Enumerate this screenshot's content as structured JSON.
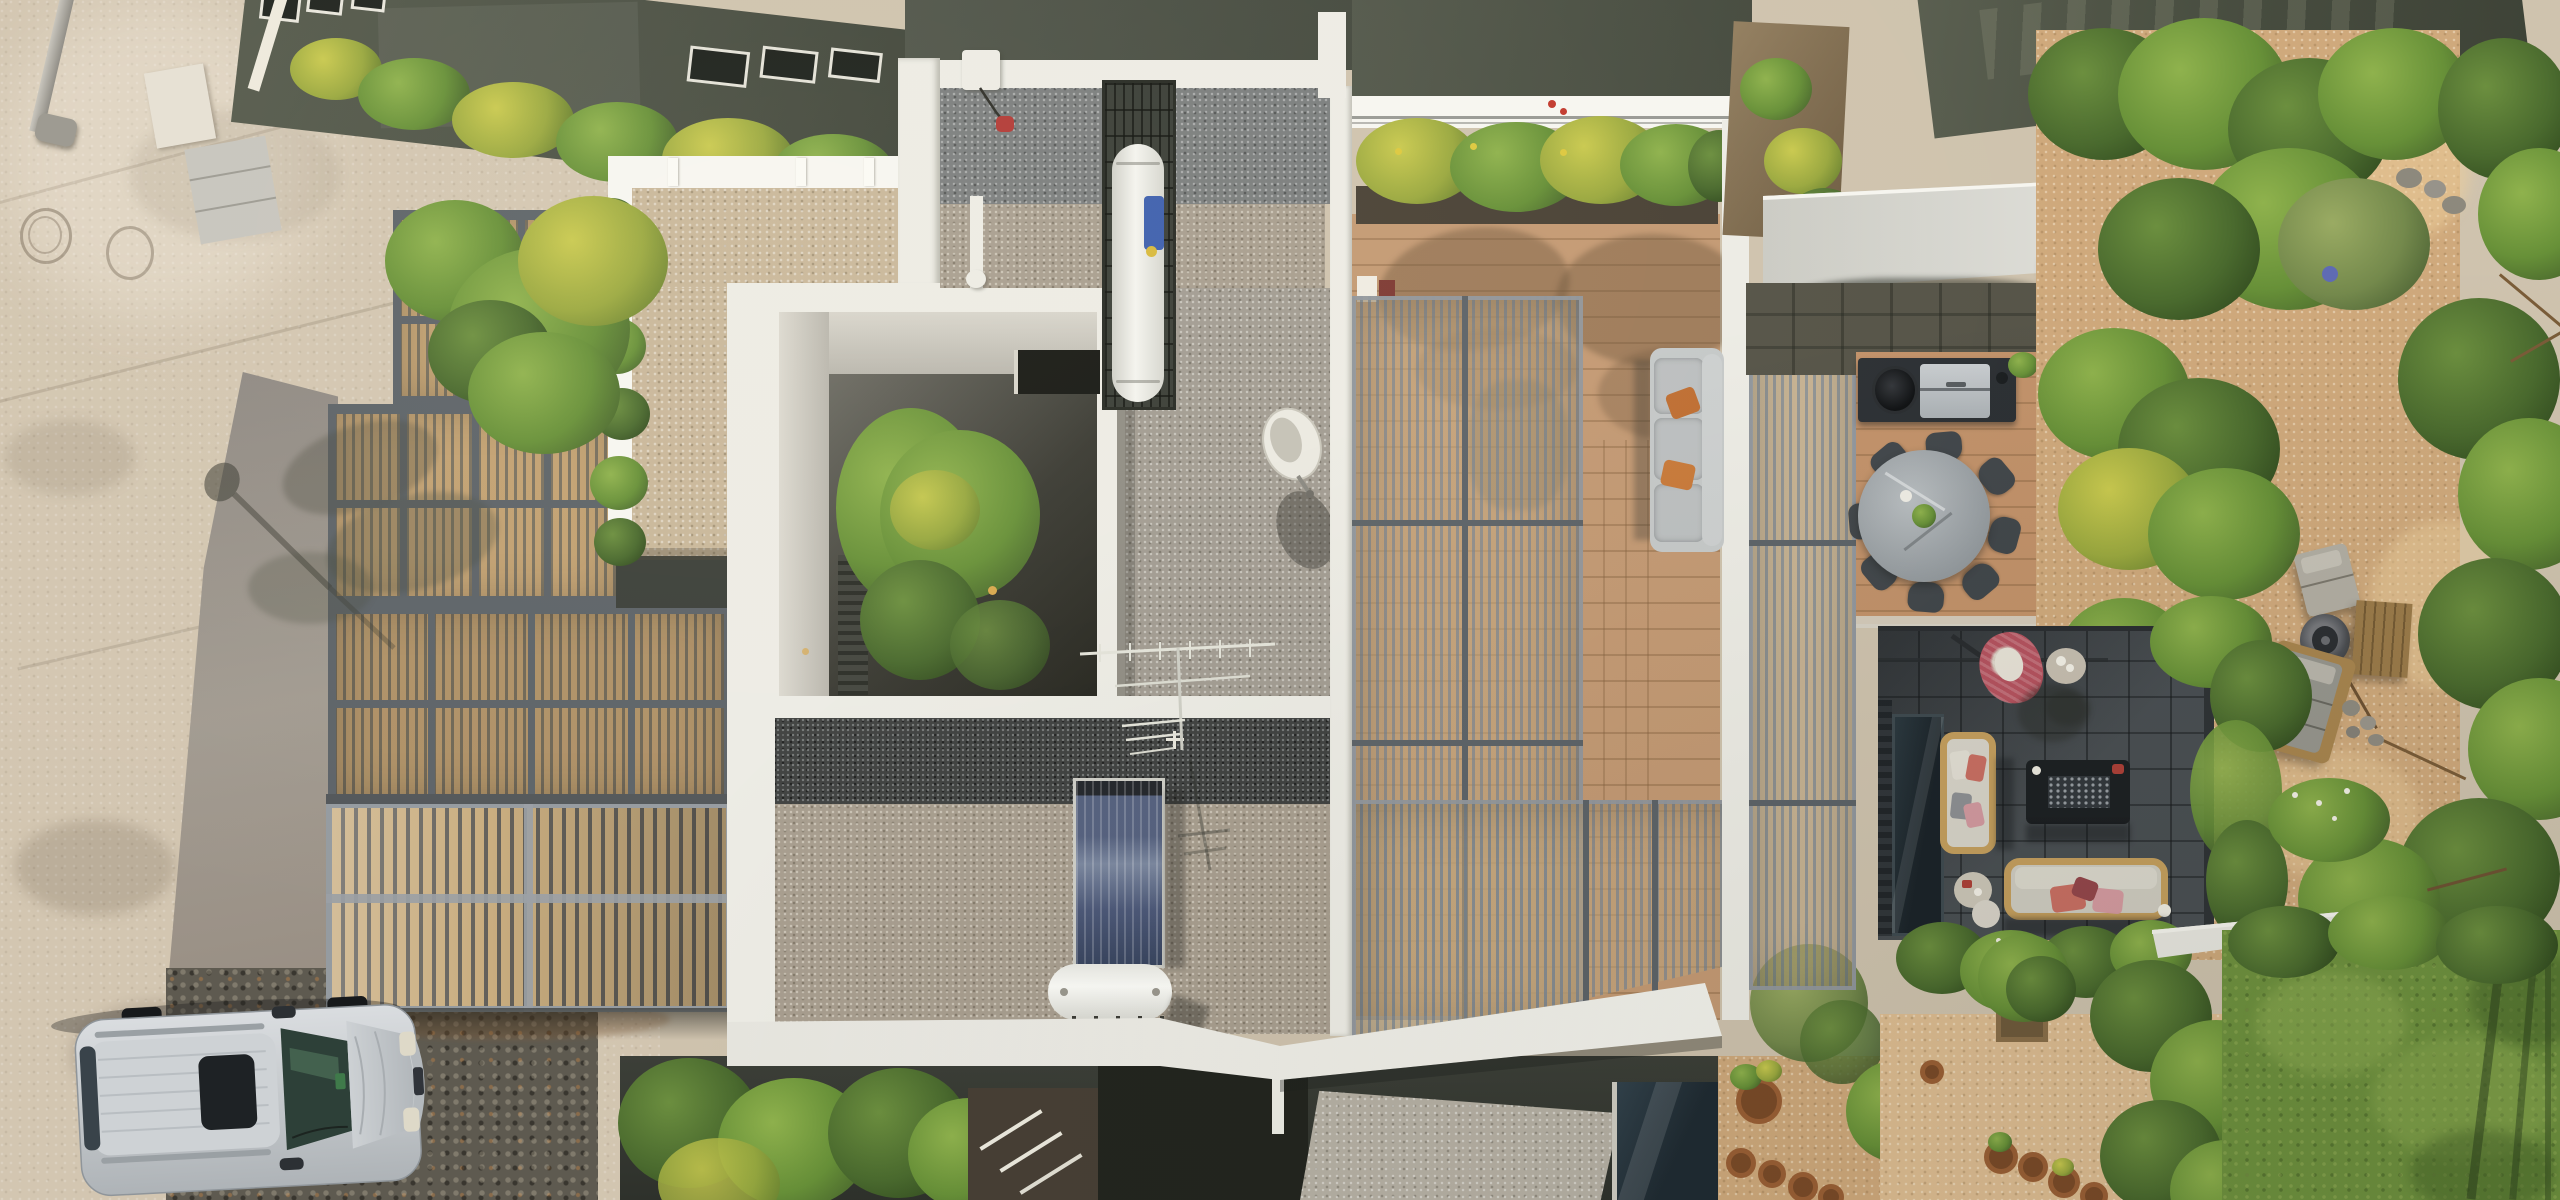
{
  "scene": {
    "description": "Overhead drone photograph of a modern flat-roofed house: beige street and silver SUV at left, slatted louver pergola roof and garage gate, white-bordered gravel roofs, open courtyard with a green tree, solar panel and water tank, east timber-deck terrace with privacy screens and gray sofa, thin white cantilevered canopy, outdoor kitchen, round dining table, sandy garden with fire pit, dark stone lounge patio and a green lawn at lower right",
    "lighting": "bright sunny daylight, hard shadows"
  },
  "palette": {
    "street": "#d3c6b1",
    "streetLight": "#ddd1bd",
    "driveway": "#96908a",
    "cobble": "#5e5a50",
    "roofOlive": "#4f5447",
    "white": "#edece5",
    "whiteBright": "#f7f6f1",
    "beigeGravel": "#c9b79a",
    "grayGravel": "#7b7e7e",
    "warmGravel": "#a89e8f",
    "midGravel": "#a29c92",
    "darkGravel": "#5f5e58",
    "pergFrame": "#5d6368",
    "pergSlat": "#c2a172",
    "gateSlat": "#c9ad7f",
    "deck": "#c49a74",
    "deckWarm": "#c2926a",
    "screen": "#848b91",
    "sofaGray": "#b7bbbd",
    "pillowOrange": "#c06f33",
    "canopy": "#d9d8d1",
    "sand": "#cfa97c",
    "sandLight": "#debd92",
    "patio": "#4a4f53",
    "lawn": "#6f923f",
    "glass": "#25313a",
    "suv": "#c9cdd0",
    "marble": "#a6abae",
    "terracotta": "#a8683c",
    "copper": "#b5713a",
    "blue": "#3d5fae",
    "panelBlue": "#4d5f87",
    "red": "#b23a36",
    "pillowPink": "#c4848b",
    "pillowMaroon": "#94464b",
    "eggChair": "#b5535f",
    "woodFrame": "#c59f5e"
  },
  "objects": {
    "street": {
      "label": "concrete street with expansion joints and two manhole covers"
    },
    "street_lamp": {
      "label": "street lamp casting a long shadow on the pavement"
    },
    "suv": {
      "label": "silver SUV parked on cobblestone apron",
      "color": "#c9cdd0"
    },
    "driveway": {
      "label": "gray concrete driveway leading to the slatted garage gate"
    },
    "garage_gate": {
      "label": "wood-slat garage gate with gray steel frame"
    },
    "louvered_roof": {
      "label": "slatted louver pergola roof over the west wing"
    },
    "beige_gravel_roof": {
      "label": "white-bordered beige gravel roof"
    },
    "courtyard": {
      "label": "open lightwell with green courtyard tree inside white roof opening"
    },
    "gravel_roof": {
      "label": "gray pebble roof with TV antenna and satellite dish"
    },
    "satellite_dish": {
      "label": "white satellite dish with shadow"
    },
    "tv_antenna": {
      "label": "aluminium TV antenna casting thin shadows"
    },
    "water_heater_cage": {
      "label": "white cylindrical tank inside rooftop metal cage"
    },
    "roof_vent": {
      "label": "white roof vent with cable and red junction box"
    },
    "solar_panel": {
      "label": "solar thermal collector on the gravel roof",
      "color": "#4d5f87"
    },
    "solar_tank": {
      "label": "white horizontal solar tank with copper pipe and two blue caps"
    },
    "terrace": {
      "label": "east terrace: flower planter, timber deck, slatted privacy screens"
    },
    "terrace_sofa": {
      "label": "gray outdoor sofa with two orange cushions",
      "pillow_count": 2,
      "pillow_color": "#c06f33"
    },
    "canopy": {
      "label": "thin white cantilevered canopy tapering to a point"
    },
    "outdoor_kitchen": {
      "label": "dark counter with stainless barbecue grill and round kamado"
    },
    "dining_set": {
      "label": "round stone dining table with eight dark chairs on timber deck",
      "chair_count": 8
    },
    "sand_garden": {
      "label": "sandy garden with fire-pit drum, wooden coffee table, lounger, chaise and stones"
    },
    "lower_patio": {
      "label": "dark stone lounge patio with fire table, hanging egg chair and two wood-framed sofas"
    },
    "egg_chair": {
      "label": "red-pink woven hanging egg chair",
      "color": "#b5535f"
    },
    "fire_table": {
      "label": "black rectangular fire table with glass crystals"
    },
    "patio_sofas": {
      "label": "wood-framed sofas with light cushions and pink pillows",
      "count": 2
    },
    "flower_pots": {
      "label": "terracotta plant pots in the lower garden",
      "count": 6
    },
    "lawn": {
      "label": "green lawn at the lower right corner"
    },
    "neighbor_roofs": {
      "label": "neighboring dark flat roofs with skylights along the top edge"
    },
    "vegetation": {
      "label": "shrubs, yellow flowering bushes and trees around the house"
    }
  },
  "counts": {
    "manholes": 2,
    "dining_chairs": 8,
    "orange_pillows": 2,
    "skylights": 6
  }
}
